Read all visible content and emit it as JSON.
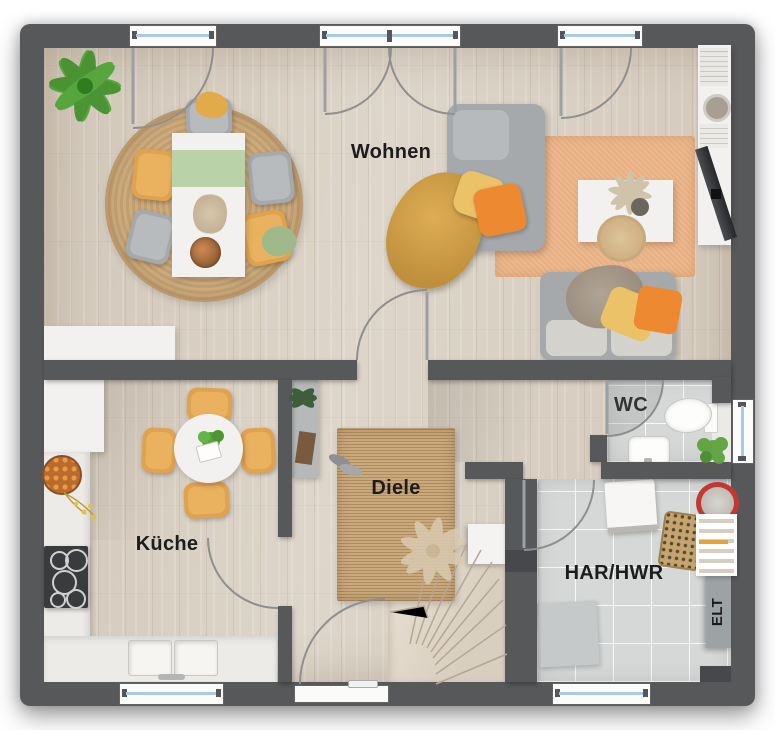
{
  "floorplan": {
    "rooms": [
      {
        "id": "wohnen",
        "label": "Wohnen"
      },
      {
        "id": "kueche",
        "label": "Küche"
      },
      {
        "id": "diele",
        "label": "Diele"
      },
      {
        "id": "wc",
        "label": "WC"
      },
      {
        "id": "har_hwr",
        "label": "HAR/HWR"
      },
      {
        "id": "elt",
        "label": "ELT"
      }
    ],
    "colors": {
      "wall": "#57585a",
      "wood": "#dad1c4",
      "tile": "#d6d8d8",
      "counter": "#ecebe7",
      "rug_peach": "#ecb98f",
      "jute": "#c6a273",
      "sofa": "#a6a9ab",
      "chair": "#e0a24f",
      "pillow_orange": "#ed8a31",
      "pillow_yellow": "#ecc268",
      "throw_mustard": "#d7a34c",
      "runner_green": "#b9d2a8",
      "plant": "#4aa331",
      "glass": "#aac9e2"
    }
  }
}
